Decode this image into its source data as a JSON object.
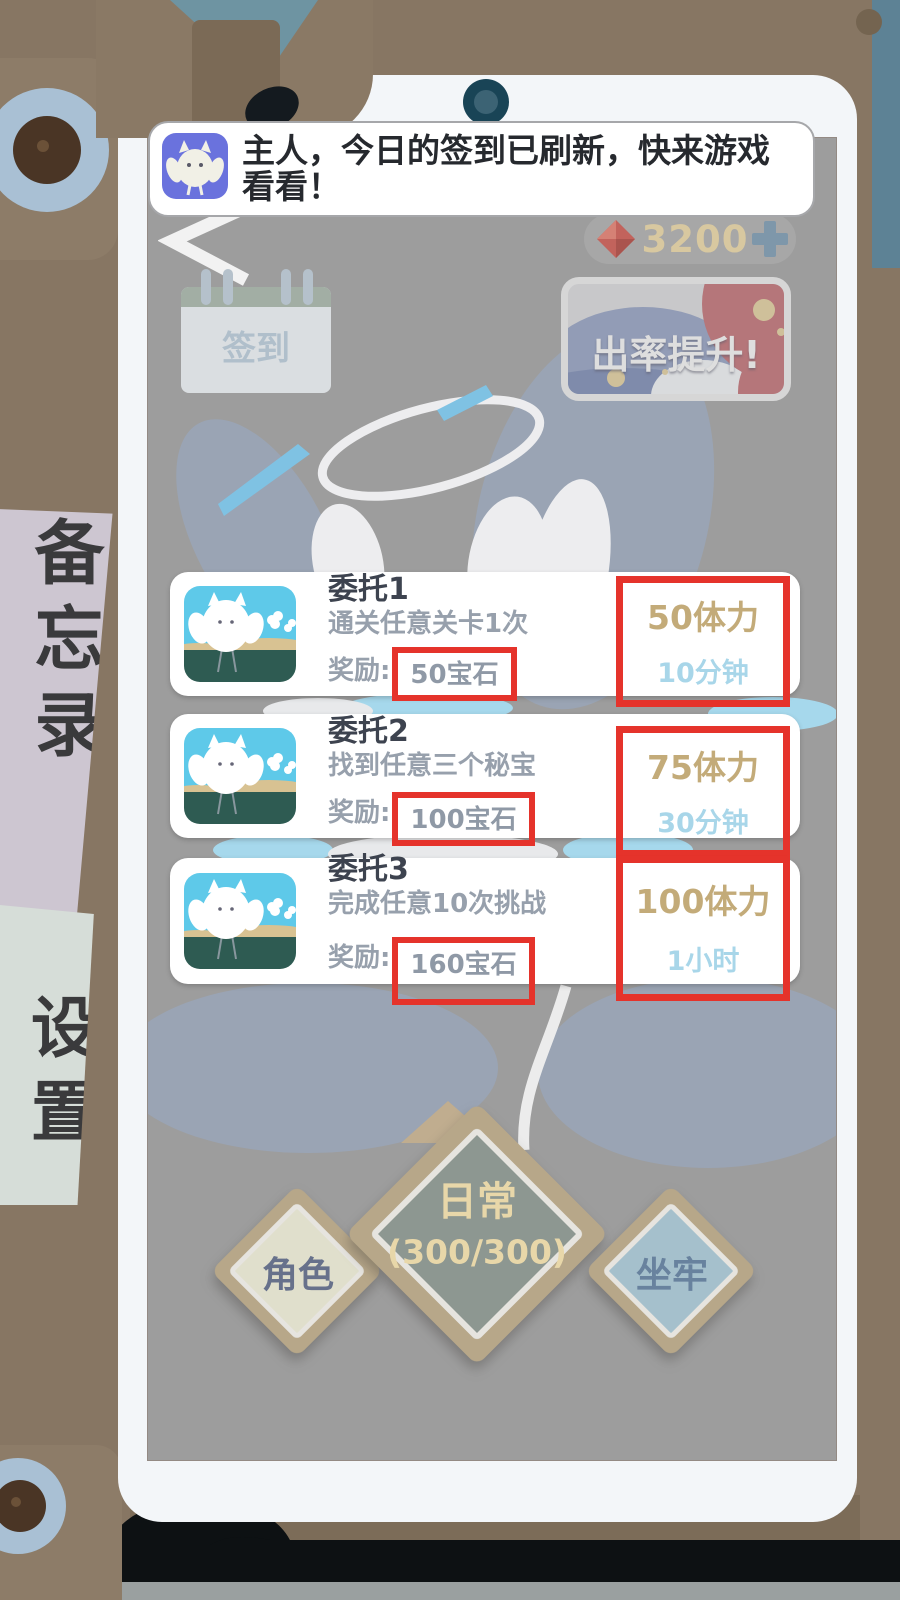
{
  "notification": {
    "icon": "owl-app-icon",
    "message": "主人，今日的签到已刷新，快来游戏看看！"
  },
  "topbar": {
    "back_icon": "back-arrow",
    "currency": {
      "gem_icon": "red-gem",
      "amount": "3200",
      "plus_icon": "plus"
    }
  },
  "banners": {
    "signin": {
      "icon": "calendar",
      "label": "签到"
    },
    "rateup": {
      "label": "出率提升!"
    }
  },
  "quests": [
    {
      "title": "委托1",
      "desc": "通关任意关卡1次",
      "reward_label": "奖励:",
      "reward_gems": "50宝石",
      "stamina": "50体力",
      "duration": "10分钟"
    },
    {
      "title": "委托2",
      "desc": "找到任意三个秘宝",
      "reward_label": "奖励:",
      "reward_gems": "100宝石",
      "stamina": "75体力",
      "duration": "30分钟"
    },
    {
      "title": "委托3",
      "desc": "完成任意10次挑战",
      "reward_label": "奖励:",
      "reward_gems": "160宝石",
      "stamina": "100体力",
      "duration": "1小时"
    }
  ],
  "nav": [
    {
      "label": "角色"
    },
    {
      "label": "日常",
      "sub": "(300/300)"
    },
    {
      "label": "坐牢"
    }
  ],
  "side_tabs": [
    {
      "label": "备忘录"
    },
    {
      "label": "设置"
    }
  ],
  "colors": {
    "annotation_red": "#e5332b",
    "stamina_gold": "#c3ab79",
    "duration_blue": "#a8d6e9",
    "currency_cream": "#d8c8a0",
    "app_icon_purple": "#6a72dd"
  }
}
